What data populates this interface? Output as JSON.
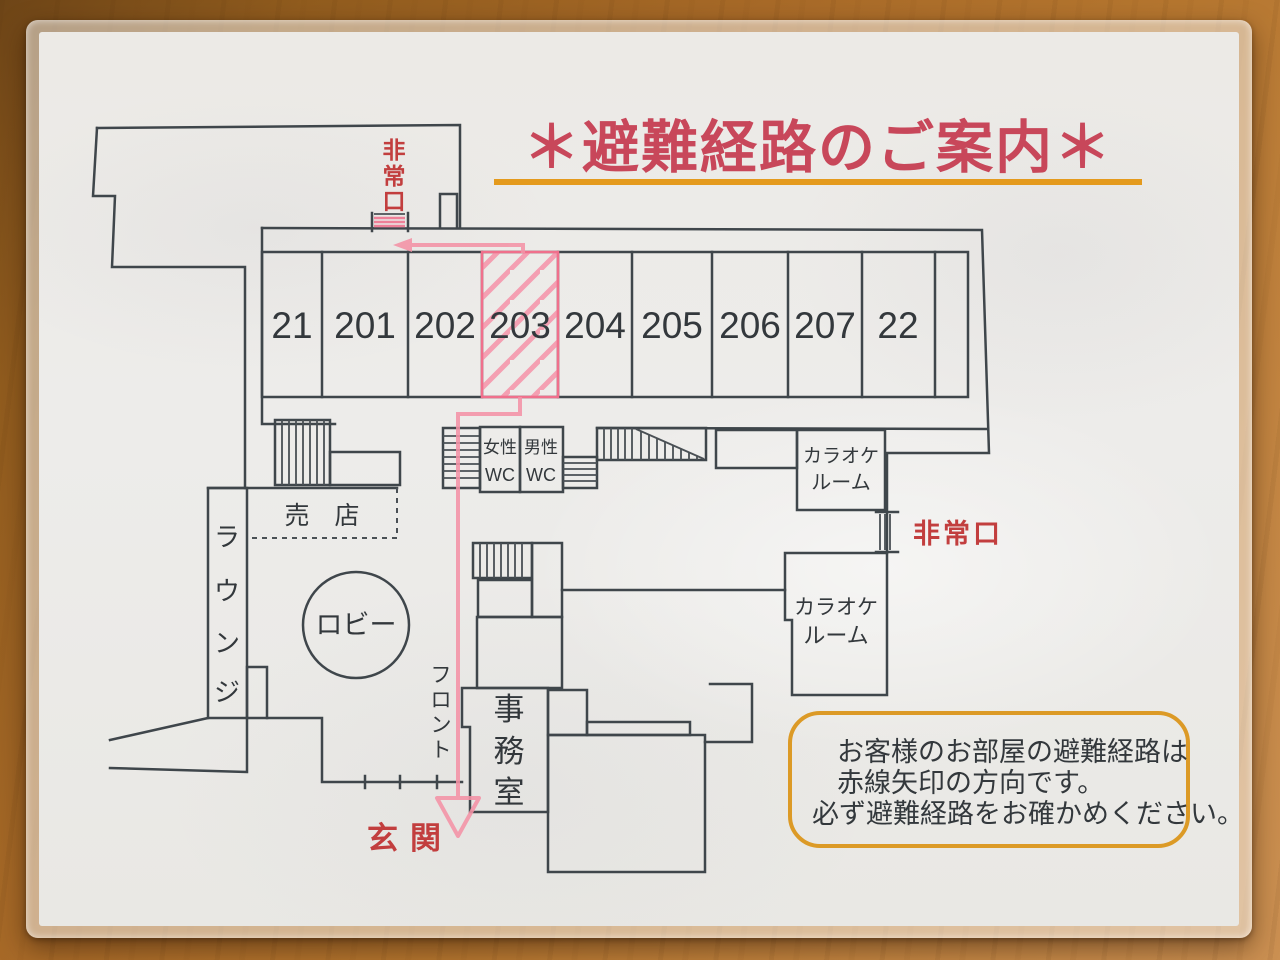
{
  "title": "＊避難経路のご案内＊",
  "rooms": [
    "21",
    "201",
    "202",
    "203",
    "204",
    "205",
    "206",
    "207",
    "22"
  ],
  "highlighted_room": "203",
  "labels": {
    "exit_top": "非常口",
    "exit_right": "非常口",
    "wc_women_l1": "女性",
    "wc_women_l2": "WC",
    "wc_men_l1": "男性",
    "wc_men_l2": "WC",
    "karaoke_l1": "カラオケ",
    "karaoke_l2": "ルーム",
    "shop": "売　店",
    "lounge": "ラウンジ",
    "lobby": "ロビー",
    "front": "フロント",
    "office": "事務室",
    "entrance": "玄関"
  },
  "note": {
    "lines": [
      "お客様のお部屋の避難経路は",
      "赤線矢印の方向です。",
      "必ず避難経路をお確かめください。"
    ]
  },
  "colors": {
    "title_red": "#c8475a",
    "underline_orange": "#e49a1d",
    "route_pink": "#f492a6",
    "label_red": "#c23e3e",
    "wall_gray": "#3f464b",
    "note_border": "#dc9a26",
    "paper": "#ecebe7",
    "wood": "#a86a28"
  }
}
